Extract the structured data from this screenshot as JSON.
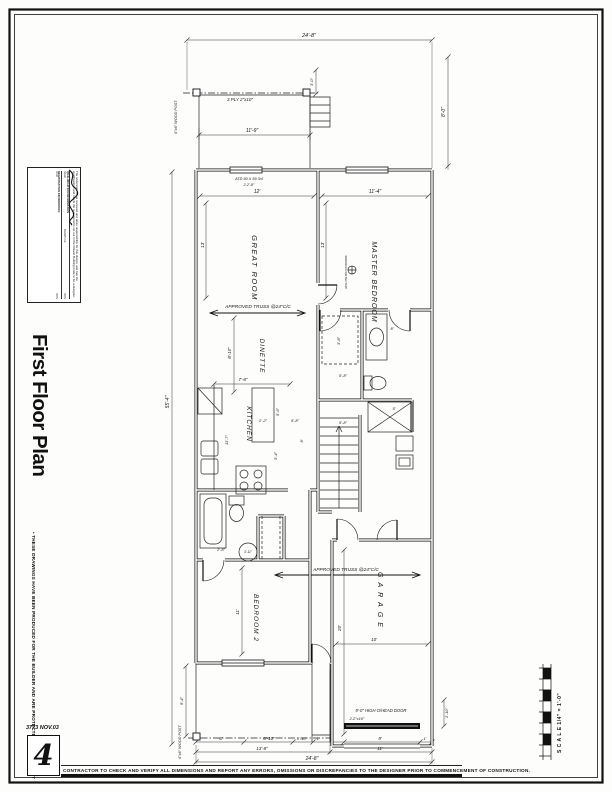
{
  "sheet": {
    "title": "First Floor Plan",
    "copyright_note": "• THESE DRAWINGS HAVE BEEN PRODUCED FOR THE BUILDER AND ARE PROTECTED BY COPYRIGHT",
    "job_number": "3773",
    "date": "NOV.03",
    "sheet_number": "4",
    "contractor_note": "CONTRACTOR TO CHECK AND VERIFY ALL DIMENSIONS AND REPORT ANY ERRORS, OMISSIONS OR DISCREPANCIES TO THE DESIGNER PRIOR TO COMMENCEMENT OF CONSTRUCTION.",
    "scale_label": "S C A L E   1/4\" = 1'-0\""
  },
  "stamp": {
    "declaration": "The undersigned has reviewed and takes responsibility for this design, and has the qualifications and meets the requirements set out in the Ontario Building Code to be a designer.",
    "qualification_header": "QUALIFICATION INFORMATION",
    "name_label": "NAME",
    "signature_label": "SIGNATURE",
    "bcin_label": "BCIN",
    "registration_header": "REGISTRATION INFORMATION",
    "firm_label": "FIRM"
  },
  "plan": {
    "labels": [
      {
        "t": "GREAT ROOM",
        "x": 252,
        "y": 268,
        "rot": 90,
        "s": 7.5,
        "ls": 1.5,
        "n": "room-label-great-room"
      },
      {
        "t": "MASTER BEDROOM",
        "x": 372,
        "y": 282,
        "rot": 90,
        "s": 7,
        "ls": 1,
        "n": "room-label-master-bedroom"
      },
      {
        "t": "DINETTE",
        "x": 260,
        "y": 356,
        "rot": 90,
        "s": 6.5,
        "ls": 1,
        "n": "room-label-dinette"
      },
      {
        "t": "KITCHEN",
        "x": 247,
        "y": 424,
        "rot": 90,
        "s": 6.5,
        "ls": 1,
        "n": "room-label-kitchen"
      },
      {
        "t": "BEDROOM 2",
        "x": 254,
        "y": 618,
        "rot": 90,
        "s": 6.5,
        "ls": 1,
        "n": "room-label-bedroom-2"
      },
      {
        "t": "GARAGE",
        "x": 378,
        "y": 602,
        "rot": 90,
        "s": 7,
        "ls": 5,
        "n": "room-label-garage"
      },
      {
        "t": "24'-8\"",
        "x": 309,
        "y": 37,
        "s": 5.5
      },
      {
        "t": "11'-9\"",
        "x": 252,
        "y": 132,
        "s": 5
      },
      {
        "t": "12'",
        "x": 257,
        "y": 193,
        "s": 5
      },
      {
        "t": "11'-4\"",
        "x": 375,
        "y": 193,
        "s": 5
      },
      {
        "t": "7'-8\"",
        "x": 243,
        "y": 381
      },
      {
        "t": "2'-2\"",
        "x": 263,
        "y": 422,
        "s": 4
      },
      {
        "t": "5'-8\"",
        "x": 295,
        "y": 422,
        "s": 4
      },
      {
        "t": "5'-8\"",
        "x": 343,
        "y": 377,
        "s": 4
      },
      {
        "t": "5'-8\"",
        "x": 343,
        "y": 424,
        "s": 4
      },
      {
        "t": "5'",
        "x": 394,
        "y": 410,
        "s": 4
      },
      {
        "t": "8'",
        "x": 392,
        "y": 330,
        "s": 4
      },
      {
        "t": "2'-8\"",
        "x": 221,
        "y": 551,
        "s": 4
      },
      {
        "t": "10'",
        "x": 374,
        "y": 641
      },
      {
        "t": "6'",
        "x": 221,
        "y": 740
      },
      {
        "t": "6'-10\"",
        "x": 269,
        "y": 740
      },
      {
        "t": "1'-10\"",
        "x": 302,
        "y": 740,
        "s": 4
      },
      {
        "t": "1'",
        "x": 318,
        "y": 740,
        "s": 4
      },
      {
        "t": "9'",
        "x": 380,
        "y": 740
      },
      {
        "t": "1'",
        "x": 425,
        "y": 740,
        "s": 4
      },
      {
        "t": "13'-8\"",
        "x": 262,
        "y": 750
      },
      {
        "t": "11'",
        "x": 380,
        "y": 750
      },
      {
        "t": "24'-8\"",
        "x": 312,
        "y": 760,
        "s": 5
      },
      {
        "t": "55'-4\"",
        "x": 169,
        "y": 402,
        "rot": -90,
        "s": 5
      },
      {
        "t": "13'",
        "x": 204,
        "y": 245,
        "rot": -90
      },
      {
        "t": "13'",
        "x": 324,
        "y": 245,
        "rot": -90
      },
      {
        "t": "8'-10\"",
        "x": 231,
        "y": 353,
        "rot": -90
      },
      {
        "t": "5'-6\"",
        "x": 279,
        "y": 412,
        "rot": -90,
        "s": 4
      },
      {
        "t": "11'-7\"",
        "x": 228,
        "y": 440,
        "rot": -90,
        "s": 4
      },
      {
        "t": "3'-4\"",
        "x": 277,
        "y": 456,
        "rot": -90,
        "s": 4
      },
      {
        "t": "3'-8\"",
        "x": 340,
        "y": 341,
        "rot": -90,
        "s": 4
      },
      {
        "t": "8'",
        "x": 303,
        "y": 441,
        "rot": -90,
        "s": 4
      },
      {
        "t": "11'",
        "x": 239,
        "y": 612,
        "rot": -90
      },
      {
        "t": "20'",
        "x": 341,
        "y": 628,
        "rot": -90
      },
      {
        "t": "3'-0\"",
        "x": 313,
        "y": 82,
        "rot": -90,
        "s": 4
      },
      {
        "t": "8'-0\"",
        "x": 445,
        "y": 112,
        "rot": -90,
        "s": 5
      },
      {
        "t": "1'-10\"",
        "x": 448,
        "y": 713,
        "rot": -90,
        "s": 4
      },
      {
        "t": "5'-4\"",
        "x": 183,
        "y": 701,
        "rot": -90,
        "s": 4
      },
      {
        "t": "3'-11\"",
        "x": 248,
        "y": 553,
        "s": 3.2
      },
      {
        "t": "3 PLY 2\"x10\"",
        "x": 240,
        "y": 101,
        "n": "porch-beam-note"
      },
      {
        "t": "6\"x6\" WOOD POST",
        "x": 177,
        "y": 117,
        "rot": -90,
        "s": 3.8,
        "n": "wood-post-note"
      },
      {
        "t": "6\"x6\" WOOD POST",
        "x": 181,
        "y": 742,
        "rot": -90,
        "s": 3.8,
        "n": "wood-post-note"
      },
      {
        "t": "ATD 60 X 59 3/4",
        "x": 249,
        "y": 180,
        "s": 3.8,
        "n": "window-note"
      },
      {
        "t": "2-2'-8\"",
        "x": 249,
        "y": 186,
        "s": 3.8,
        "n": "window-note"
      },
      {
        "t": "APPROVED TRUSS @24\"C/C",
        "x": 258,
        "y": 308,
        "s": 4.8,
        "n": "truss-note"
      },
      {
        "t": "APPROVED TRUSS @24\"C/C",
        "x": 346,
        "y": 571,
        "s": 4.8,
        "n": "truss-note"
      },
      {
        "t": "9'-0\" HIGH O/HEAD DOOR",
        "x": 381,
        "y": 712,
        "s": 4.2,
        "n": "garage-door-note"
      },
      {
        "t": "2-2\"x10\"",
        "x": 357,
        "y": 720,
        "s": 4,
        "n": "garage-door-note"
      },
      {
        "t": "SMOKE/CO DETECTOR",
        "x": 345,
        "y": 272,
        "rot": 90,
        "s": 3,
        "n": "smoke-detector-note"
      }
    ]
  }
}
